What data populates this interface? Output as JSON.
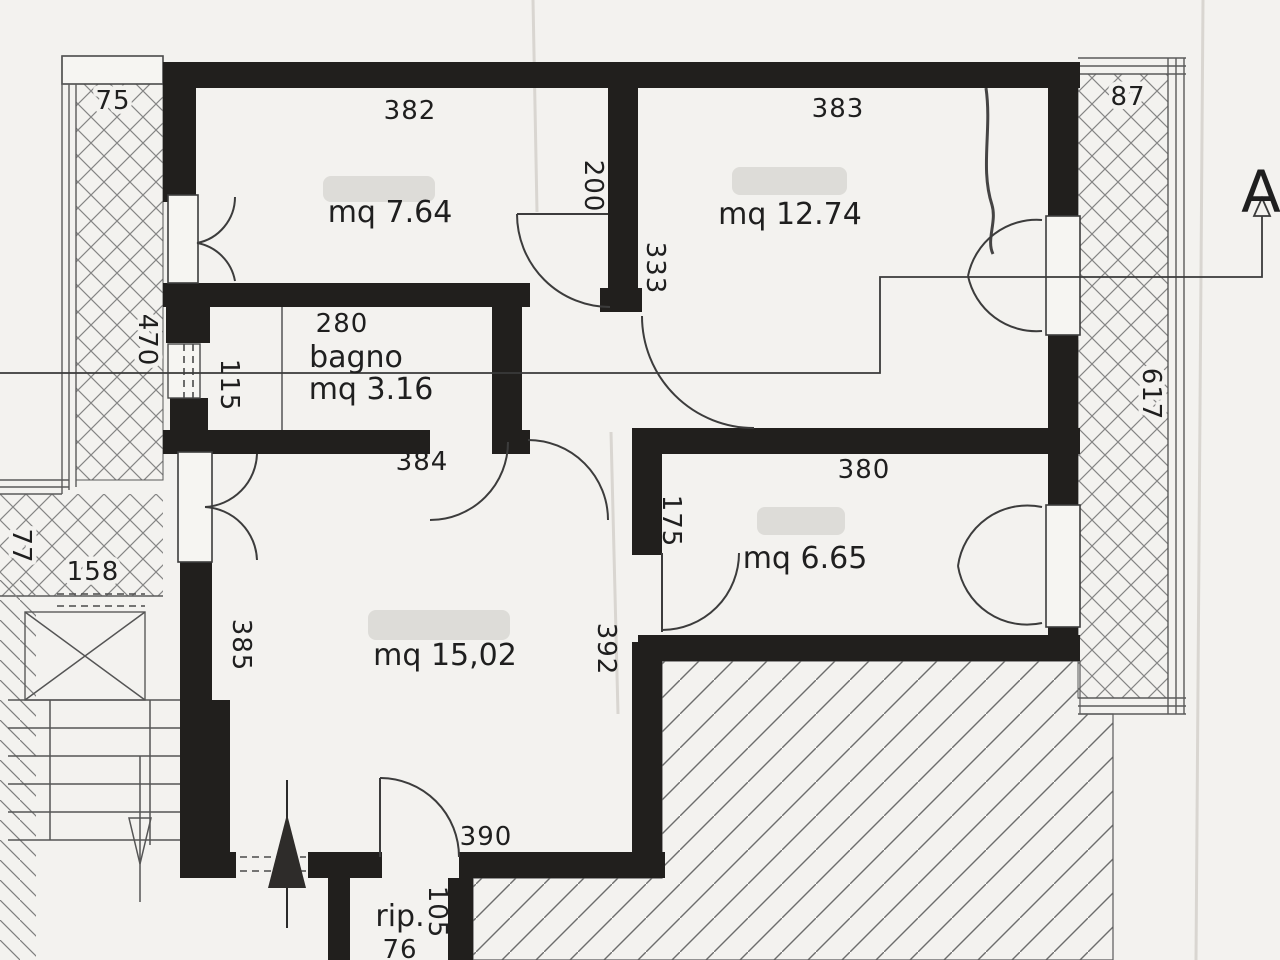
{
  "plan": {
    "section_marker": "A",
    "rooms": {
      "room382": {
        "area": "mq 7.64"
      },
      "room383": {
        "area": "mq 12.74"
      },
      "bagno": {
        "name": "bagno",
        "area": "mq 3.16"
      },
      "room380": {
        "area": "mq 6.65"
      },
      "soggiorno": {
        "area": "mq 15,02"
      },
      "rip": {
        "name": "rip."
      }
    },
    "dims": {
      "d75": "75",
      "d77": "77",
      "d87": "87",
      "d105": "105",
      "d115": "115",
      "d158": "158",
      "d175": "175",
      "d200": "200",
      "d280": "280",
      "d333": "333",
      "d380": "380",
      "d382": "382",
      "d383": "383",
      "d384": "384",
      "d385": "385",
      "d390": "390",
      "d392": "392",
      "d470": "470",
      "d617": "617",
      "d76": "76"
    },
    "colors": {
      "wall": "#211f1d",
      "paper": "#f3f2ef",
      "hatch": "#7d7d7d"
    }
  }
}
